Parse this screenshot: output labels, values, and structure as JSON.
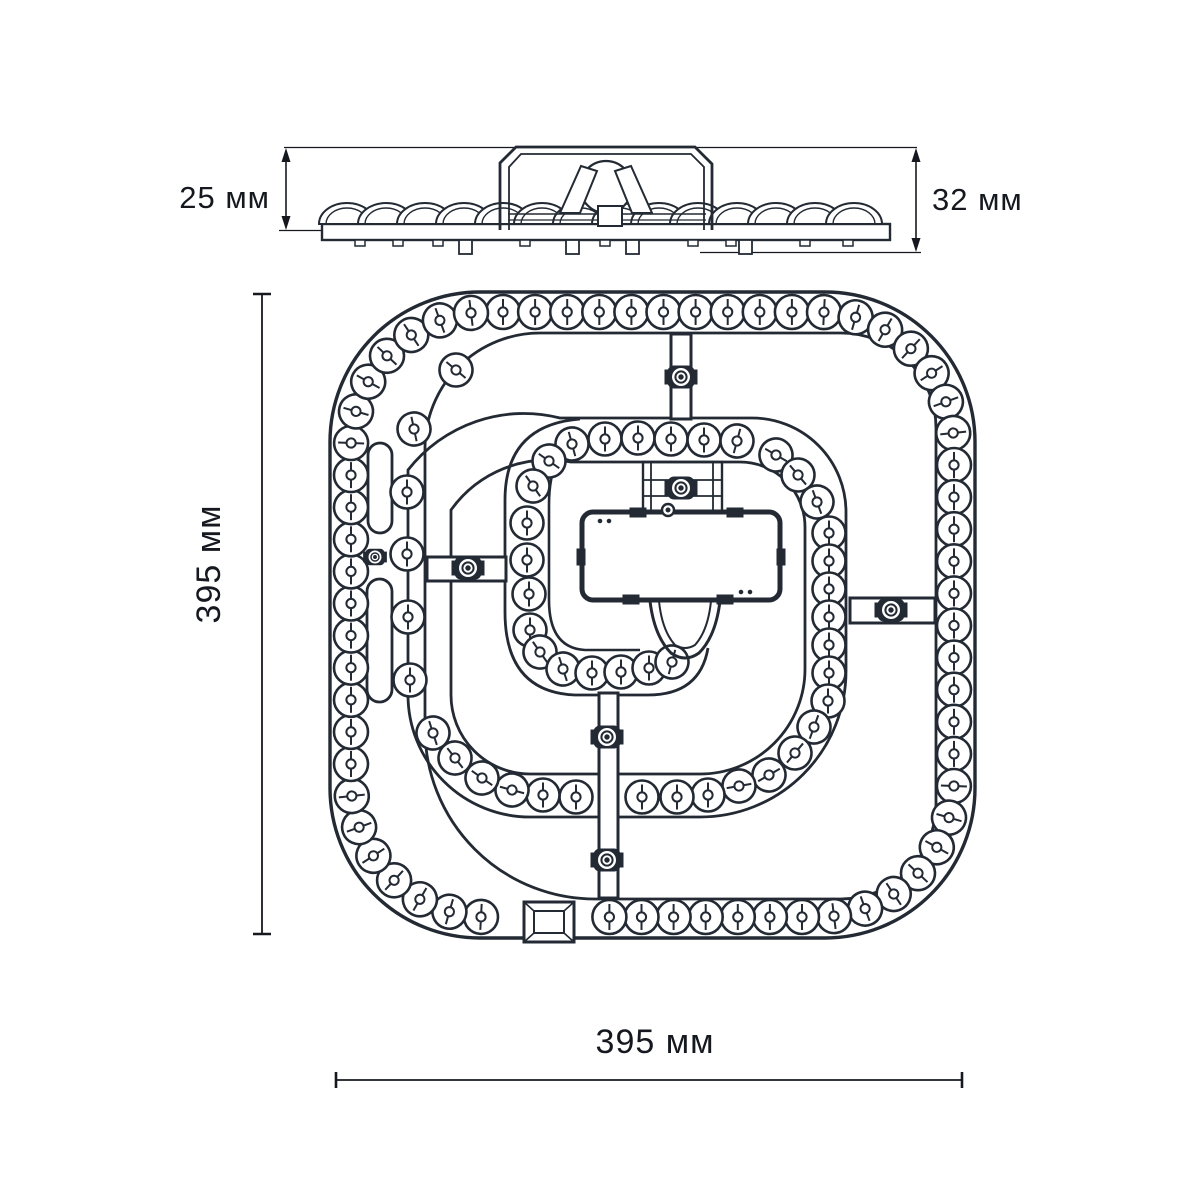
{
  "labels": {
    "side_height_small": "25 мм",
    "side_height_total": "32 мм",
    "plan_height": "395 мм",
    "plan_width": "395 мм"
  },
  "colors": {
    "line": "#232a34",
    "dim": "#15191f",
    "bg": "#ffffff"
  },
  "plan": {
    "outer_ring": {
      "x": 351,
      "y": 312,
      "w": 603,
      "h": 605,
      "r": 136,
      "count": 68,
      "led_r": 17,
      "skip_cx": 549,
      "skip_cy": 918,
      "skip_r": 44
    },
    "inner_leds": [
      [
        572,
        444,
        -15
      ],
      [
        605,
        439,
        0
      ],
      [
        638,
        438,
        0
      ],
      [
        671,
        439,
        0
      ],
      [
        704,
        440,
        0
      ],
      [
        737,
        441,
        15
      ],
      [
        776,
        455,
        -60
      ],
      [
        798,
        475,
        -40
      ],
      [
        817,
        502,
        -20
      ],
      [
        829,
        533,
        0
      ],
      [
        829,
        561,
        0
      ],
      [
        829,
        589,
        0
      ],
      [
        829,
        617,
        0
      ],
      [
        829,
        645,
        0
      ],
      [
        829,
        673,
        0
      ],
      [
        828,
        701,
        0
      ],
      [
        814,
        727,
        20
      ],
      [
        795,
        753,
        40
      ],
      [
        769,
        775,
        60
      ],
      [
        739,
        786,
        80
      ],
      [
        708,
        795,
        0
      ],
      [
        677,
        797,
        0
      ],
      [
        642,
        797,
        0
      ],
      [
        576,
        797,
        0
      ],
      [
        543,
        795,
        0
      ],
      [
        512,
        790,
        -75
      ],
      [
        482,
        778,
        -55
      ],
      [
        455,
        758,
        -38
      ],
      [
        433,
        733,
        -18
      ],
      [
        410,
        680,
        0
      ],
      [
        408,
        617,
        0
      ],
      [
        407,
        554,
        0
      ],
      [
        407,
        492,
        0
      ],
      [
        414,
        429,
        -12
      ],
      [
        456,
        370,
        -50
      ],
      [
        549,
        461,
        -55
      ],
      [
        533,
        486,
        -35
      ],
      [
        527,
        523,
        0
      ],
      [
        527,
        560,
        0
      ],
      [
        529,
        594,
        0
      ],
      [
        530,
        630,
        0
      ],
      [
        540,
        652,
        -35
      ],
      [
        563,
        669,
        -18
      ],
      [
        592,
        673,
        0
      ],
      [
        621,
        672,
        0
      ],
      [
        649,
        668,
        0
      ],
      [
        672,
        662,
        15
      ]
    ],
    "screw_posts": [
      [
        681,
        377
      ],
      [
        468,
        568
      ],
      [
        891,
        610
      ],
      [
        607,
        737
      ],
      [
        607,
        860
      ],
      [
        681,
        488
      ]
    ],
    "small_screws": [
      [
        375,
        557
      ]
    ],
    "tiny_circles": [
      [
        668,
        510
      ]
    ],
    "slots": [
      [
        368,
        443,
        24,
        90
      ],
      [
        367,
        579,
        25,
        123
      ]
    ],
    "spokes": [
      [
        671,
        334,
        20,
        85
      ],
      [
        427,
        557,
        79,
        24
      ],
      [
        850,
        598,
        85,
        25
      ],
      [
        599,
        693,
        19,
        205
      ]
    ],
    "connector": {
      "x": 524,
      "y": 902,
      "w": 50,
      "h": 40
    }
  },
  "side": {
    "scallop_centers": [
      347,
      386,
      425,
      464,
      503,
      542,
      581,
      620,
      659,
      698,
      737,
      776,
      815,
      854
    ],
    "pins": [
      [
        459,
        240,
        13,
        14
      ],
      [
        566,
        240,
        13,
        14
      ],
      [
        626,
        240,
        13,
        14
      ],
      [
        739,
        240,
        13,
        14
      ]
    ],
    "feet": [
      [
        355,
        240,
        10,
        6
      ],
      [
        393,
        240,
        10,
        6
      ],
      [
        433,
        240,
        10,
        6
      ],
      [
        520,
        240,
        10,
        6
      ],
      [
        600,
        240,
        10,
        6
      ],
      [
        688,
        240,
        10,
        6
      ],
      [
        726,
        240,
        10,
        6
      ],
      [
        800,
        240,
        10,
        6
      ],
      [
        843,
        240,
        10,
        6
      ]
    ]
  }
}
